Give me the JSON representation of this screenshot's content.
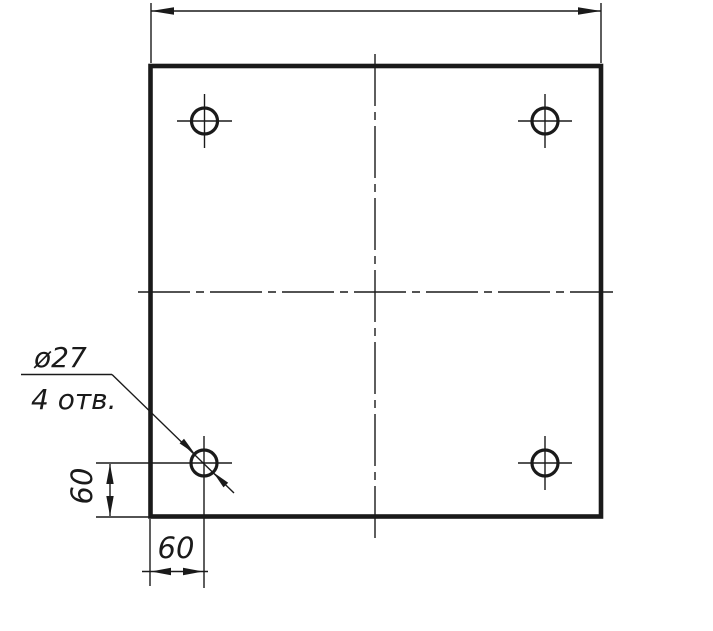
{
  "drawing": {
    "labels": {
      "leader_line1": "ø27",
      "leader_line2": "4 отв.",
      "left_dim": "60",
      "bottom_dim": "60",
      "top_dim": ""
    },
    "semantics": {
      "hole_count": 4,
      "hole_diameter_mm": 27,
      "hole_offset_from_left_mm": 60,
      "hole_offset_from_bottom_mm": 60
    },
    "colors": {
      "line": "#1a1a1a",
      "background": "#ffffff"
    }
  }
}
